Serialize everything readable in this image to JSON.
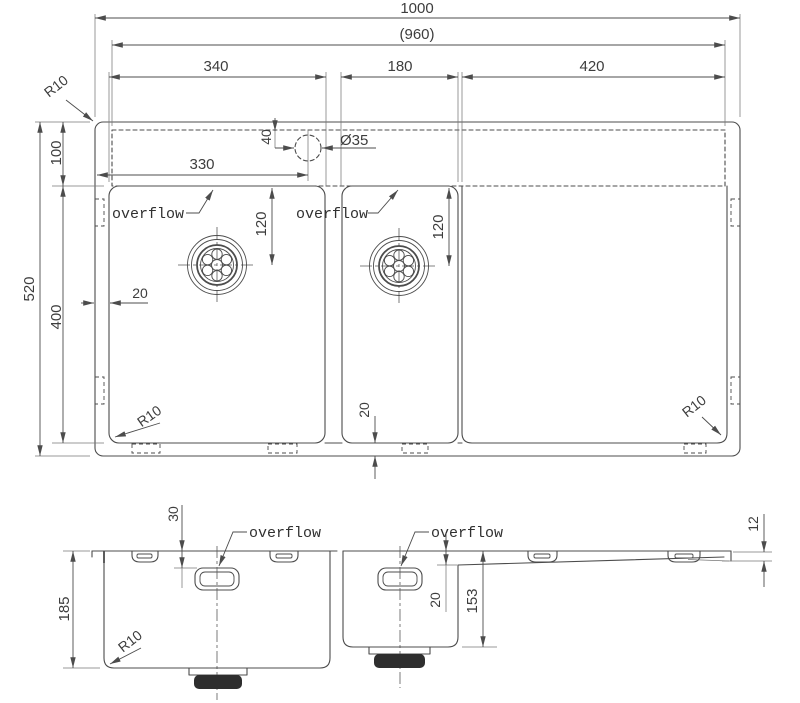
{
  "drawing": {
    "top_view": {
      "dim_overall_width": "1000",
      "dim_inner_width": "(960)",
      "dim_left_bowl_width": "340",
      "dim_right_bowl_width": "180",
      "dim_drainboard_width": "420",
      "dim_overall_depth": "520",
      "dim_rear_deck_depth": "100",
      "dim_bowl_length": "400",
      "dim_tap_hole_from_left": "330",
      "dim_tap_hole_from_back": "40",
      "dim_tap_hole_diameter": "Ø35",
      "dim_left_drain_from_back": "120",
      "dim_right_drain_from_back": "120",
      "dim_rim_gap_left": "20",
      "dim_rim_gap_bottom": "20",
      "radius_top_left": "R10",
      "radius_bottom_left": "R10",
      "radius_bottom_right": "R10",
      "overflow_label_left": "overflow",
      "overflow_label_right": "overflow"
    },
    "side_view": {
      "dim_overflow_from_rim": "30",
      "dim_left_bowl_depth": "185",
      "dim_right_bowl_depth": "153",
      "dim_drainboard_drop": "20",
      "dim_rim_lip": "12",
      "radius_bowl_corner": "R10",
      "overflow_label_left": "overflow",
      "overflow_label_right": "overflow"
    },
    "colors": {
      "line": "#4c4c4c",
      "text": "#3d3d3d",
      "drain_fill": "#2e2e2e",
      "background": "#ffffff"
    }
  }
}
